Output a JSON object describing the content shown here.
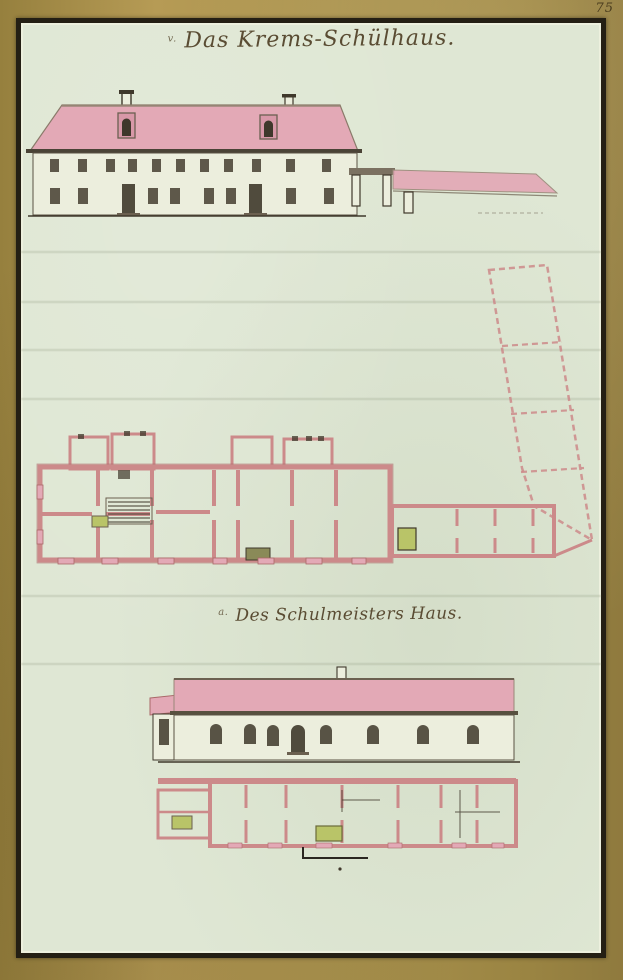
{
  "page": {
    "number": "75"
  },
  "figures": {
    "school": {
      "index_letter": "v.",
      "title": "Das Krems-Schülhaus.",
      "elevation": {
        "storeys": 2,
        "dormers": 2,
        "chimneys": 2,
        "upper_windows": 11,
        "lower_windows": 8,
        "doors": 2,
        "annex": "garden wall with gate"
      },
      "plan": {
        "top_projection_rooms": 4,
        "wing_rooms": 4,
        "courtyard_sections": 4,
        "courtyard_outline": "dashed, tilted"
      }
    },
    "house": {
      "index_letter": "a.",
      "title": "Des Schulmeisters Haus.",
      "elevation": {
        "storeys": 1,
        "arched_windows": 7,
        "doors": 2,
        "chimneys": 1,
        "left_annex": true
      },
      "plan": {
        "rooms": 7,
        "stoves": 2
      }
    }
  },
  "colors": {
    "gold": "#a8914d",
    "frame": "#241f14",
    "paper": "#dfe7d4",
    "paper_light": "#eceedd",
    "roof": "#e3a9b6",
    "roof_shade": "#d898a8",
    "wall": "#cc8a8a",
    "wall_dark": "#a96868",
    "ink": "#3f382b",
    "ink_light": "#6b6050",
    "stove": "#b9c468",
    "title_ink": "#5a4c33"
  }
}
